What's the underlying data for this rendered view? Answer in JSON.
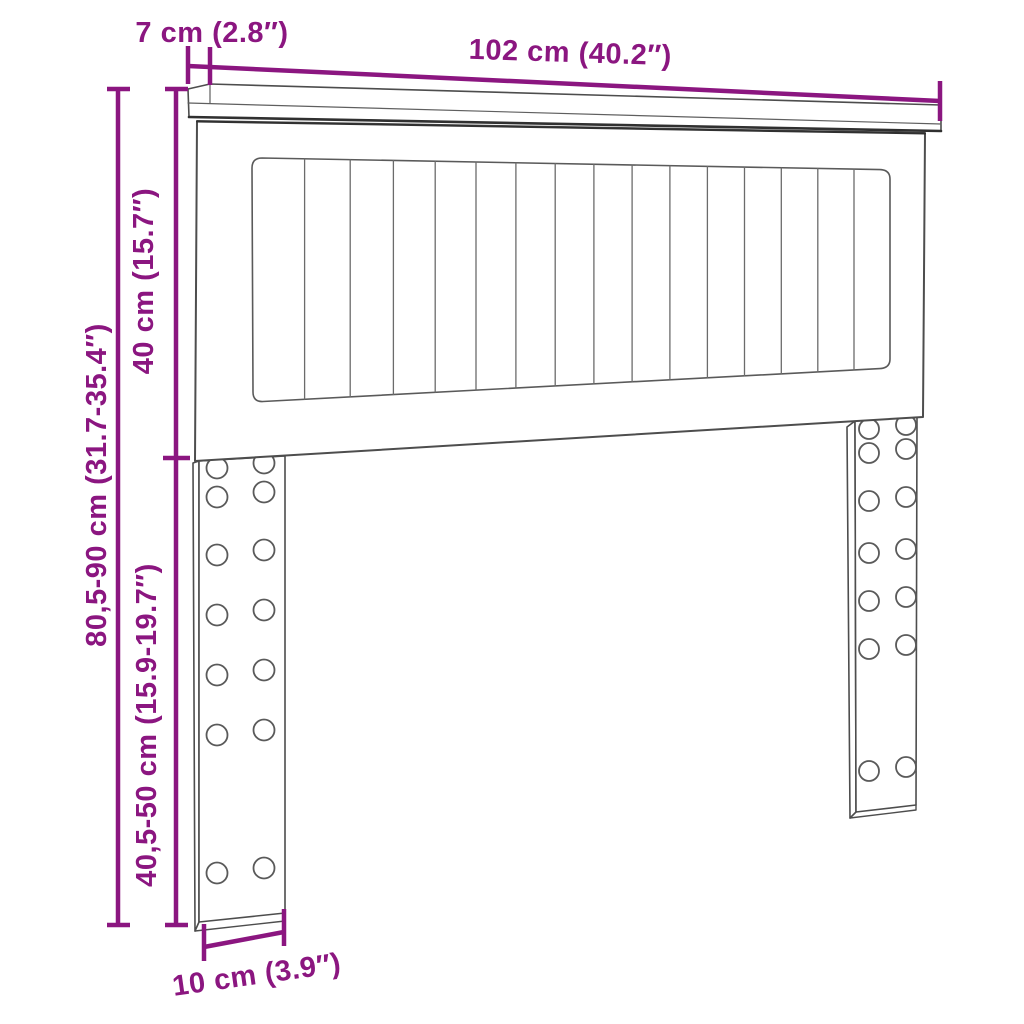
{
  "page": {
    "background": "#ffffff"
  },
  "diagram": {
    "type": "furniture-dimension-diagram",
    "subject": "headboard-with-adjustable-legs",
    "accent_color": "#8b1680",
    "outline_color": "#4d4d4d",
    "labels": {
      "shelf_depth": "7 cm (2.8″)",
      "width": "102 cm (40.2″)",
      "panel_height": "40 cm (15.7″)",
      "total_height": "80,5-90 cm (31.7-35.4″)",
      "leg_height": "40,5-50 cm (15.9-19.7″)",
      "leg_depth": "10 cm (3.9″)"
    },
    "slats": {
      "count": 16,
      "line_count": 15
    },
    "legs": {
      "count": 2,
      "hole_rows": 7,
      "hole_cols": 2
    }
  }
}
